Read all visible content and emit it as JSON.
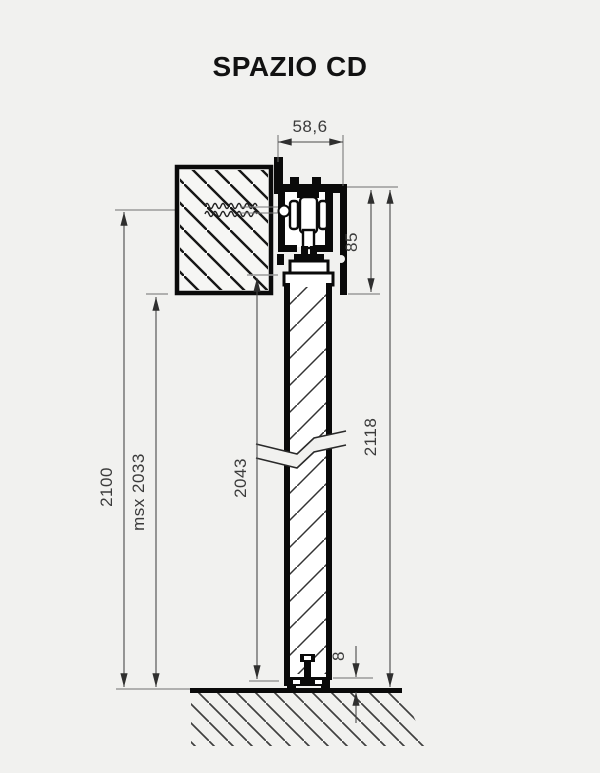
{
  "title": "SPAZIO CD",
  "dimensions": {
    "track_width": "58,6",
    "header_height": "85",
    "total_height": "2118",
    "door_height": "2043",
    "max_passage_height": "msx 2033",
    "install_height": "2100",
    "floor_gap": "8"
  },
  "colors": {
    "background": "#f1f1ef",
    "drawing_ink": "#0a0a0a",
    "dimension_text": "#3b3b3b"
  }
}
